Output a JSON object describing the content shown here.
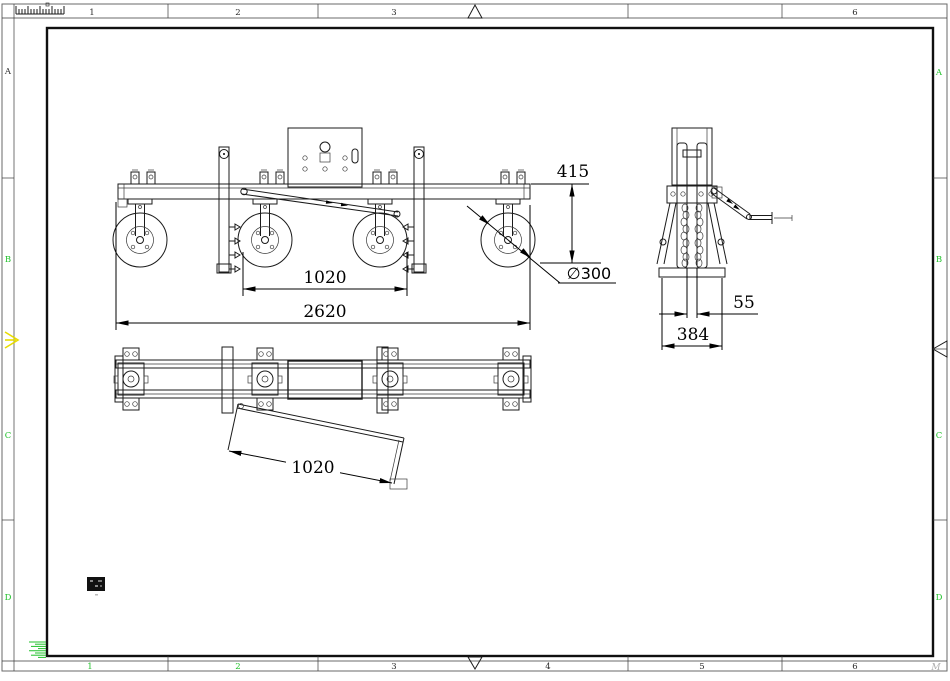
{
  "sheet": {
    "zones_top": [
      "1",
      "2",
      "3",
      "6"
    ],
    "zones_bottom": [
      "1",
      "2",
      "3",
      "4",
      "5",
      "6"
    ],
    "rows_left": [
      "A",
      "B",
      "C",
      "D"
    ],
    "rows_right": [
      "A",
      "B",
      "C",
      "D"
    ],
    "watermark": "M"
  },
  "dimensions": {
    "frame_height": "415",
    "wheel_diameter": "∅300",
    "wheel_spacing": "1020",
    "overall_length": "2620",
    "tube_gap": "55",
    "base_width": "384",
    "ramp_length": "1020"
  },
  "colors": {
    "line": "#1b1b1b",
    "dim_text": "#000000",
    "zone_green": "#21c12b",
    "center_mark_yellow": "#e8dc00",
    "watermark_gray": "#adadad",
    "paper": "#ffffff"
  }
}
